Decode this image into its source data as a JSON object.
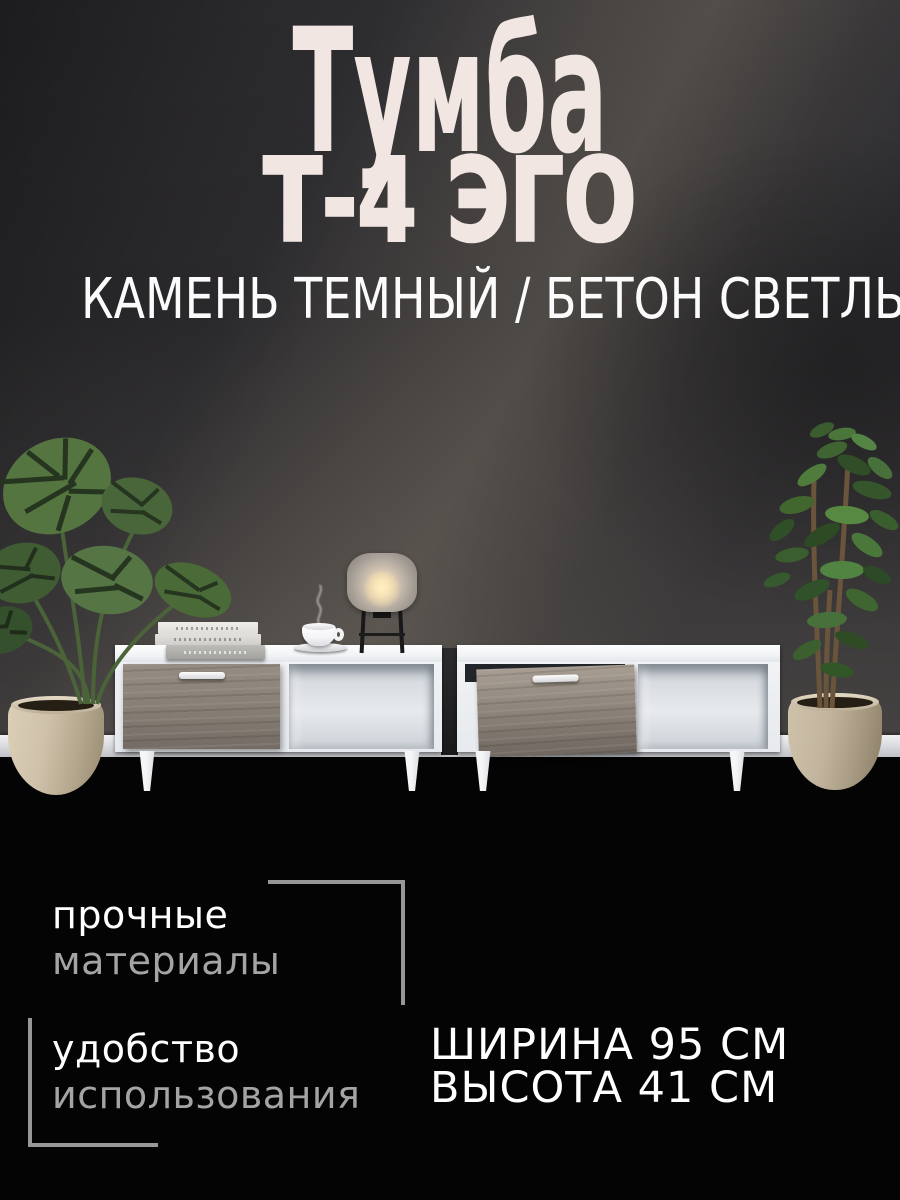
{
  "product": {
    "title_line1": "Тумба",
    "title_line2": "Т-4 ЭГО",
    "subtitle": "КАМЕНЬ ТЕМНЫЙ / БЕТОН СВЕТЛЫЙ"
  },
  "features": [
    {
      "primary": "прочные",
      "secondary": "материалы"
    },
    {
      "primary": "удобство",
      "secondary": "использования"
    }
  ],
  "specs": {
    "width_label": "ШИРИНА 95 СМ",
    "height_label": "ВЫСОТА 41 СМ"
  },
  "scene": {
    "left_plant": "monstera-plant",
    "right_plant": "ficus-plant",
    "left_unit": "tv-stand-left",
    "right_unit": "tv-stand-right",
    "decor": [
      "book-stack",
      "coffee-cup",
      "table-lamp"
    ]
  },
  "palette": {
    "wall": "#2f2e30",
    "floor": "#040404",
    "title_color": "#f2e6e2",
    "subtitle_color": "#fbfbfb",
    "feature_primary_color": "#ffffff",
    "feature_secondary_color": "#a4a4a4",
    "bracket_color": "#979797",
    "cabinet_white": "#f1f3f5",
    "drawer_wood": "#877e75",
    "pot_beige": "#c8bba3",
    "leaf_green": "#4d7037"
  }
}
